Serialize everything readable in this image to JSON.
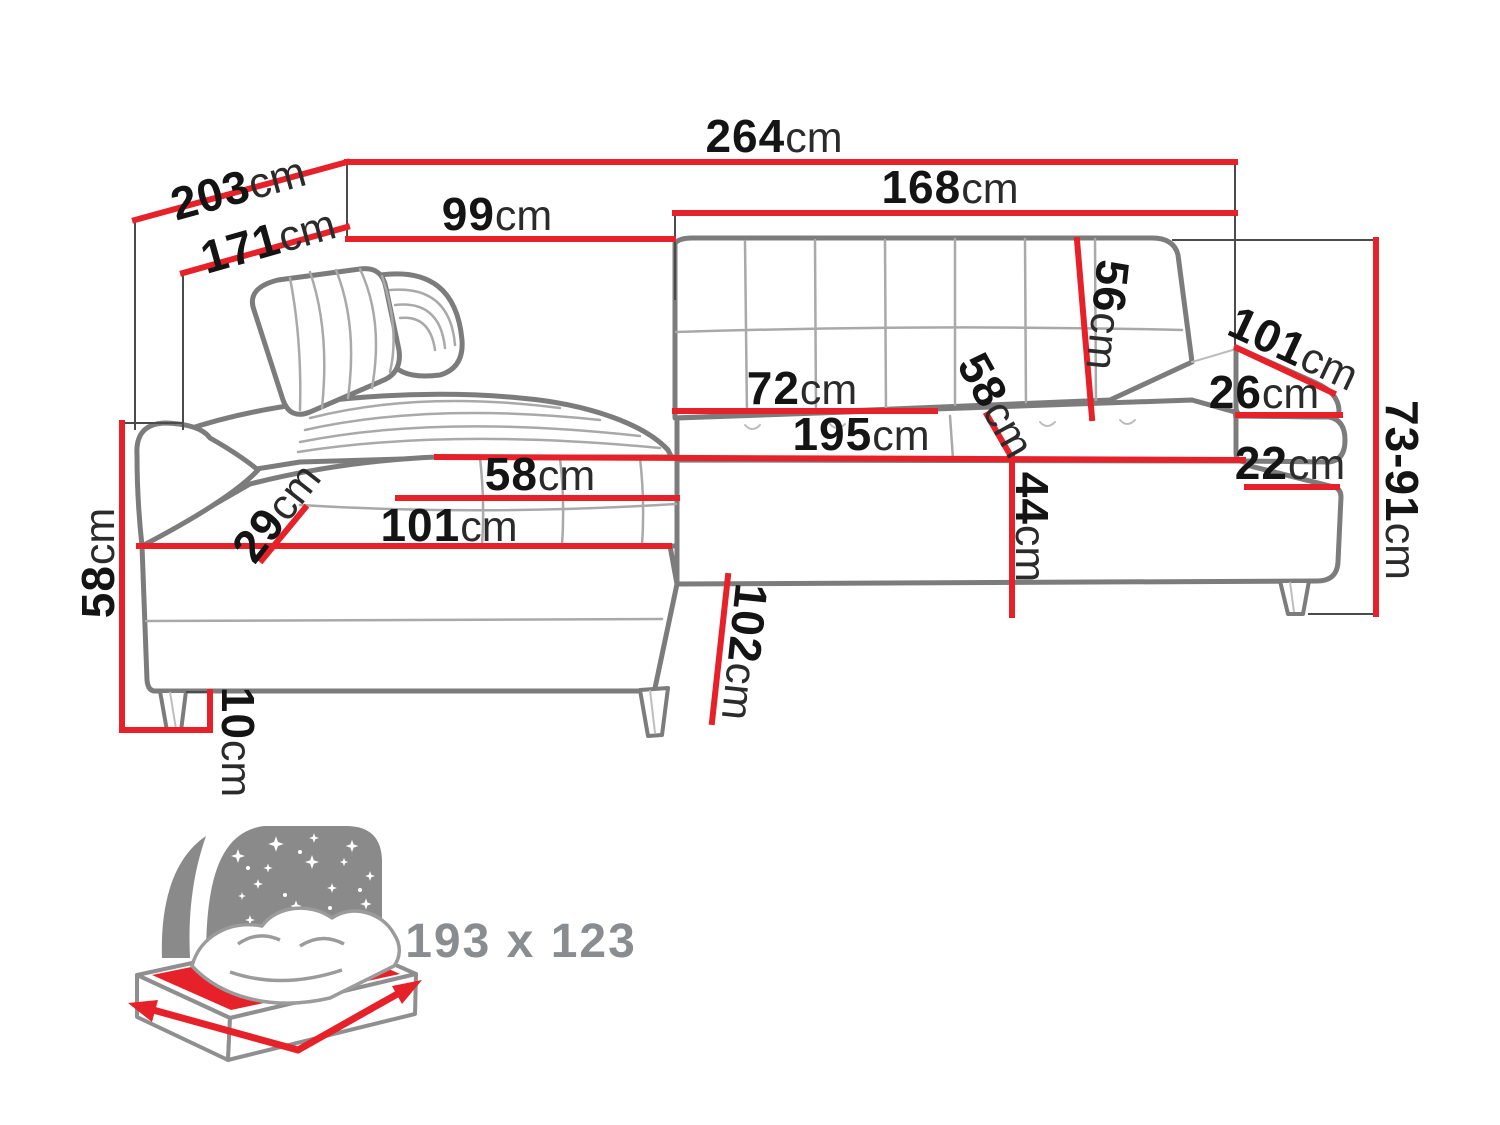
{
  "colors": {
    "dimension_line": "#e62129",
    "sofa_outline": "#7c7c7c",
    "label_text": "#141414",
    "icon_gray": "#8a8a8a"
  },
  "dimensions": {
    "width_total": {
      "value": "264",
      "unit": "cm"
    },
    "depth_total": {
      "value": "203",
      "unit": "cm"
    },
    "depth_inner": {
      "value": "171",
      "unit": "cm"
    },
    "back_width_left": {
      "value": "99",
      "unit": "cm"
    },
    "width_right_section": {
      "value": "168",
      "unit": "cm"
    },
    "backrest_height": {
      "value": "56",
      "unit": "cm"
    },
    "armrest_length": {
      "value": "101",
      "unit": "cm"
    },
    "armrest_top_width": {
      "value": "26",
      "unit": "cm"
    },
    "height_range": {
      "value": "73-91",
      "unit": "cm"
    },
    "armrest_base_width": {
      "value": "22",
      "unit": "cm"
    },
    "seat_width": {
      "value": "72",
      "unit": "cm"
    },
    "seat_depth_right": {
      "value": "58",
      "unit": "cm"
    },
    "sleeping_length": {
      "value": "195",
      "unit": "cm"
    },
    "seat_height": {
      "value": "44",
      "unit": "cm"
    },
    "seat_depth_left": {
      "value": "58",
      "unit": "cm"
    },
    "chaise_length": {
      "value": "101",
      "unit": "cm"
    },
    "headrest_offset": {
      "value": "29",
      "unit": "cm"
    },
    "side_height": {
      "value": "58",
      "unit": "cm"
    },
    "leg_height": {
      "value": "10",
      "unit": "cm"
    },
    "chaise_front_length": {
      "value": "102",
      "unit": "cm"
    }
  },
  "sleeping_area": {
    "size": "193 x 123"
  }
}
